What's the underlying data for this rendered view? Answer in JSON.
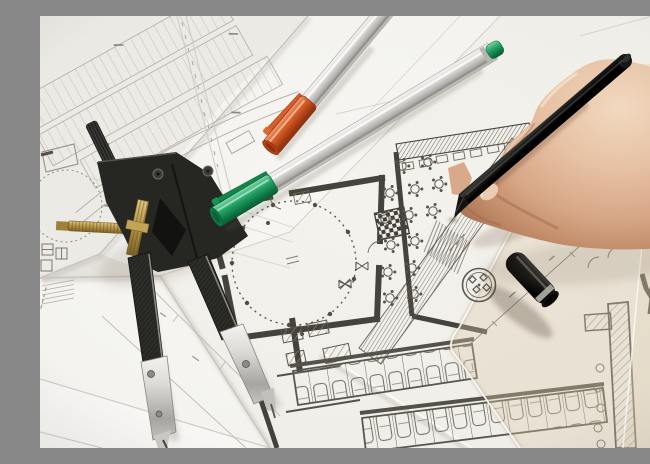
{
  "scene": {
    "title": "Photograph of an architect's desk: hand drawing on floor-plan blueprints with drafting tools",
    "legible_text": "none (all blueprint annotations are illegible micro-text)"
  },
  "objects": {
    "photo": {
      "label": "Architectural drafting workspace photograph"
    },
    "papers": {
      "label": "Overlapping white blueprint sheets"
    },
    "parking_plan": {
      "label": "Faint parking lot site plan, top left"
    },
    "side_plan": {
      "label": "Partial floor plan sheet at left edge"
    },
    "floor_plan": {
      "label": "Main floor plan with dashed circle room, table symbols, hatched walls and parking rows"
    },
    "compass": {
      "label": "Black drafting compass with brass adjustment screws and spread steel-tipped legs"
    },
    "pen_green": {
      "label": "Silver pen with green cap and clip"
    },
    "pen_orange": {
      "label": "Silver pen with orange cap and clip"
    },
    "set_square": {
      "label": "Translucent set square ruler with round logo stamp"
    },
    "stamp": {
      "label": "Round geometric logo stamp on ruler"
    },
    "cap_black": {
      "label": "Glossy black pen cap lying on ruler"
    },
    "hand": {
      "label": "Right hand gripping a black pen, drawing hatching"
    },
    "pen_black": {
      "label": "Black pen held by the hand, tip touching the plan"
    }
  },
  "colors": {
    "paper_bright": "#f8f7f3",
    "paper_mid": "#f1efe9",
    "plan_ink_dark": "#45433b",
    "plan_ink_faint": "#b7b4ab",
    "green_cap": "#1b9a5c",
    "orange_cap": "#cd5420",
    "silver_body": "#d9d8d5",
    "brass": "#bf9f50",
    "skin": "#e0b494",
    "pen_black": "#141413",
    "ruler_tint": "rgba(221,206,176,0.34)"
  }
}
